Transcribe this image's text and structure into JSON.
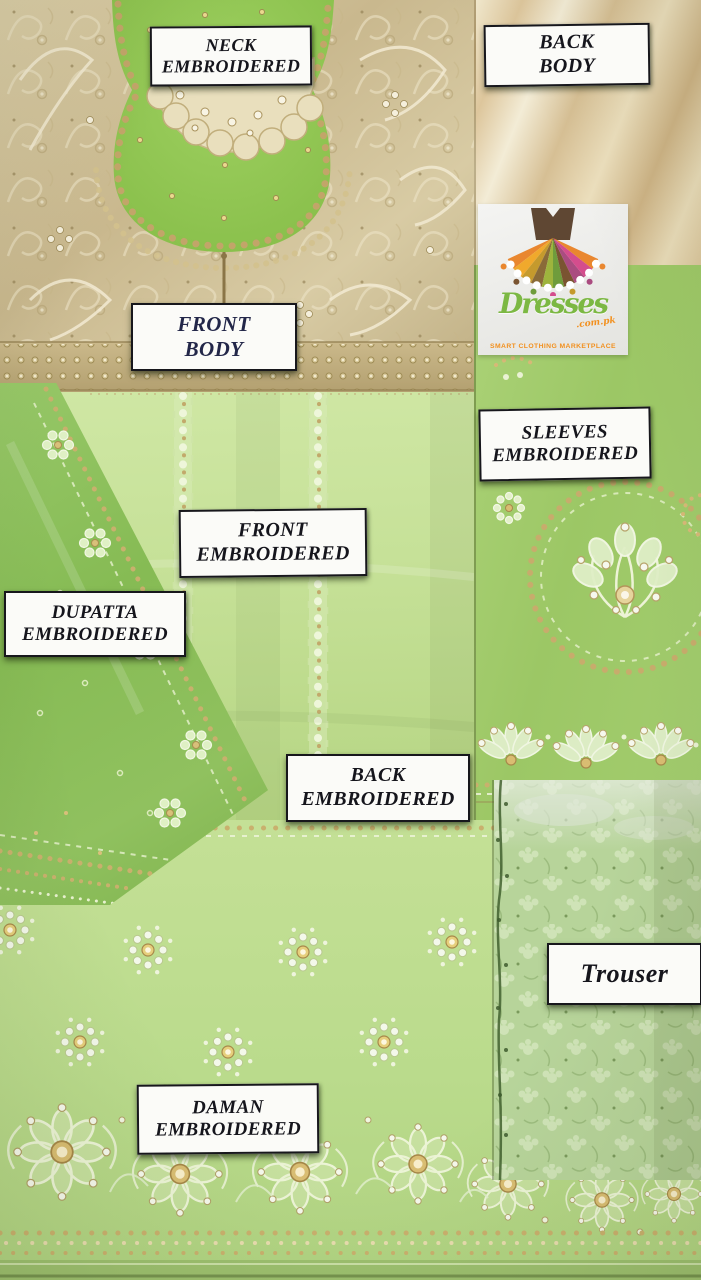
{
  "photo": {
    "labels": {
      "neck": {
        "line1": "NECK",
        "line2": "EMBROIDERED"
      },
      "back_body": {
        "line1": "BACK",
        "line2": "BODY"
      },
      "front_body": {
        "line1": "FRONT",
        "line2": "BODY"
      },
      "sleeves": {
        "line1": "SLEEVES",
        "line2": "EMBROIDERED"
      },
      "front_embroidered": {
        "line1": "FRONT",
        "line2": "EMBROIDERED"
      },
      "dupatta": {
        "line1": "DUPATTA",
        "line2": "EMBROIDERED"
      },
      "back_embroidered": {
        "line1": "BACK",
        "line2": "EMBROIDERED"
      },
      "trouser": {
        "line1": "Trouser"
      },
      "daman": {
        "line1": "DAMAN",
        "line2": "EMBROIDERED"
      }
    },
    "logo": {
      "brand": "Dresses",
      "domain": ".com.pk",
      "tagline": "SMART CLOTHING MARKETPLACE",
      "icon": "dress-icon"
    },
    "colors": {
      "label_background": "#fbfbf8",
      "label_border": "#17171c",
      "label_text": "#15151c",
      "brand_green": "#7cb843",
      "brand_orange": "#f2901e",
      "fabric_gold_beige": "#cdbb92",
      "fabric_cream": "#e8dbb8",
      "fabric_light_green": "#c6e198",
      "fabric_green": "#9cc765",
      "fabric_dark_green": "#86bb54",
      "trouser_green": "#b7d49a",
      "embroidery_gold": "#c9b06d"
    }
  }
}
